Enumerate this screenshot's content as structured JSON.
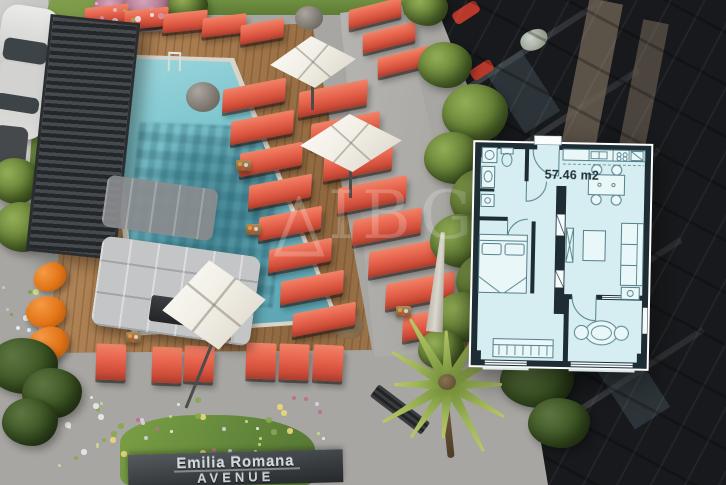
{
  "sign": {
    "line1": "Emilia Romana",
    "line2": "AVENUE"
  },
  "watermark": {
    "letters": "IBG"
  },
  "floor_plan": {
    "area_label": "57.46 m2"
  },
  "colors": {
    "pool_water": "#7fc6cf",
    "lounger_coral": "#e2604a",
    "bean_bag_orange": "#e27517",
    "plan_room_fill": "#d6eef1",
    "plan_wall": "#1e2d34",
    "deck_wood": "#a5794c",
    "building_facade": "#17191c"
  }
}
